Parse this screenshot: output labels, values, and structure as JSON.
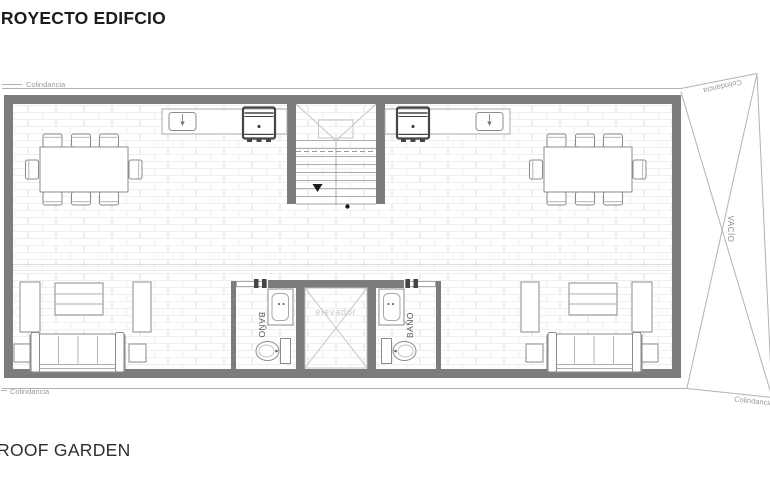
{
  "title": "PROYECTO EDIFCIO",
  "footer": {
    "label": "ROOF GARDEN"
  },
  "plan": {
    "labels": {
      "colindancia": "Colindancia",
      "vacio": "VACÍO",
      "bano": "BAÑO",
      "elevador": "elevador"
    },
    "rooms": {
      "bathroom_count": 2,
      "elevator_count": 1,
      "void_area": "VACÍO"
    },
    "colors": {
      "wall": "#7c7c7c",
      "boundary_line": "#b2b2b2",
      "furniture_line": "#8b8b8b",
      "grill_dark": "#454545",
      "label_gray": "#9a9a9a",
      "elevator_label": "#c8c8c8"
    }
  }
}
